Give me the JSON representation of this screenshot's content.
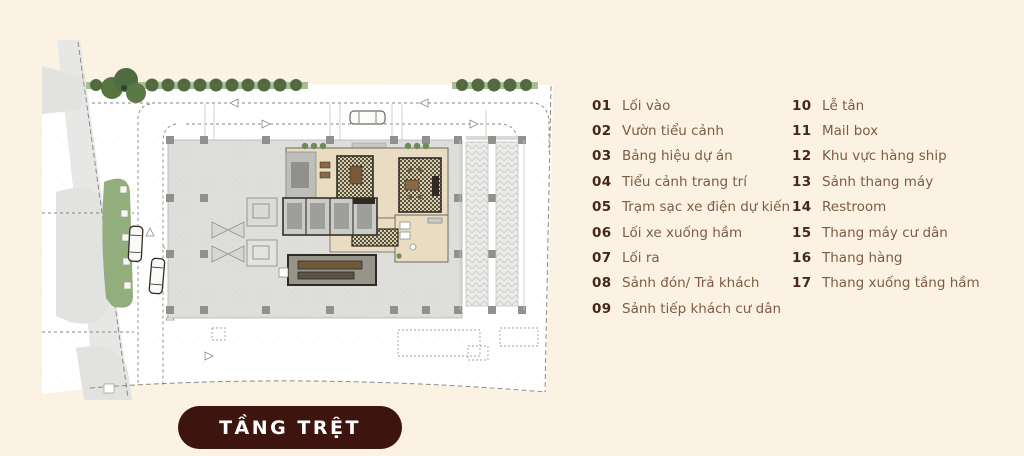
{
  "page": {
    "background_color": "#fcf2e3"
  },
  "badge": {
    "label": "TẦNG TRỆT",
    "bg_color": "#3e140e",
    "text_color": "#ffffff"
  },
  "legend": {
    "number_color": "#45281a",
    "label_color": "#7d5c45",
    "columns": [
      {
        "items": [
          {
            "num": "01",
            "label": "Lối vào"
          },
          {
            "num": "02",
            "label": "Vườn tiểu cảnh"
          },
          {
            "num": "03",
            "label": "Bảng hiệu dự án"
          },
          {
            "num": "04",
            "label": "Tiểu cảnh trang trí"
          },
          {
            "num": "05",
            "label": "Trạm sạc xe điện dự kiến"
          },
          {
            "num": "06",
            "label": "Lối xe xuống hầm"
          },
          {
            "num": "07",
            "label": "Lối ra"
          },
          {
            "num": "08",
            "label": "Sảnh đón/ Trả khách"
          },
          {
            "num": "09",
            "label": "Sảnh tiếp khách cư dân"
          }
        ]
      },
      {
        "items": [
          {
            "num": "10",
            "label": "Lễ tân"
          },
          {
            "num": "11",
            "label": "Mail box"
          },
          {
            "num": "12",
            "label": "Khu vực hàng ship"
          },
          {
            "num": "13",
            "label": "Sảnh thang máy"
          },
          {
            "num": "14",
            "label": "Restroom"
          },
          {
            "num": "15",
            "label": "Thang máy cư dân"
          },
          {
            "num": "16",
            "label": "Thang hàng"
          },
          {
            "num": "17",
            "label": "Thang xuống tầng hầm"
          }
        ]
      }
    ]
  },
  "plan": {
    "type": "ground-floor-site-plan",
    "colors": {
      "site": "#ffffff",
      "adjacent_parcel": "#e5e5e3",
      "building_footprint": "#dededc",
      "column": "#90908d",
      "lawn": "#93ae7d",
      "tree": "#4e6b41",
      "room_floor": "#e9dcc2",
      "wall": "#2f2b24",
      "carpet": "#57503c",
      "road_line": "#85857f"
    }
  }
}
